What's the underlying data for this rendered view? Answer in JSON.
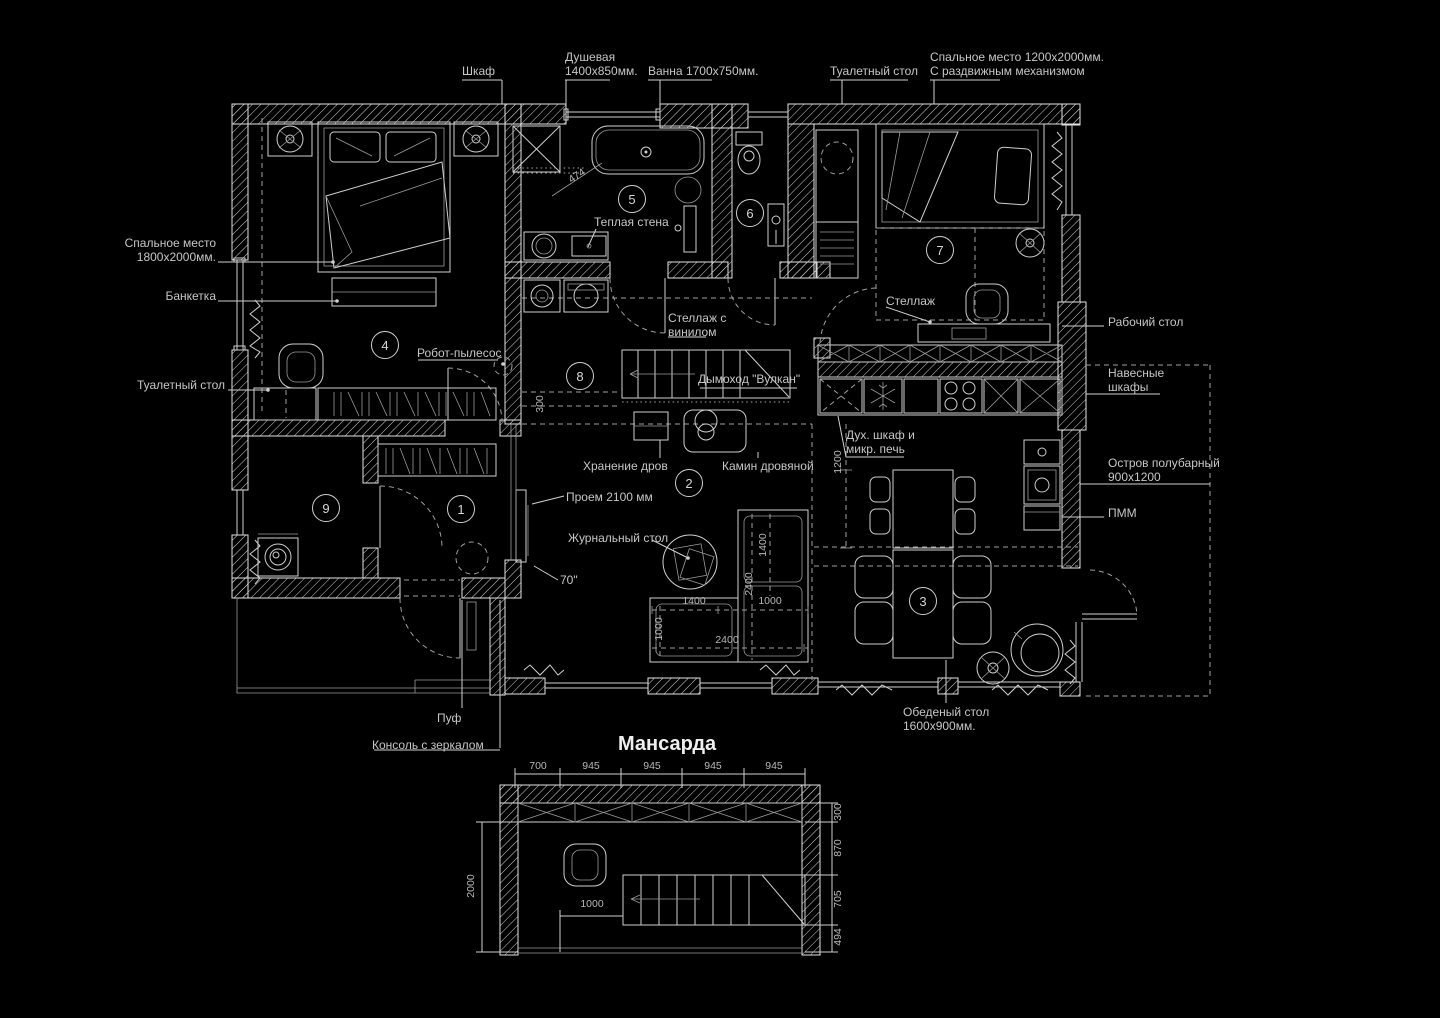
{
  "palette": {
    "background": "#000000",
    "wall_line": "#e4e4e4",
    "furniture_line": "#cfcfcf",
    "dashed_line": "#9f9f9f",
    "leader_line": "#8f8f8f",
    "text": "#c6c6c6",
    "dim_text": "#b8b8b8",
    "title_text": "#efefef"
  },
  "attic": {
    "title": "Мансарда",
    "dims_top": [
      "700",
      "945",
      "945",
      "945",
      "945"
    ],
    "dim_left": "2000",
    "dim_inner": "1000",
    "dims_right": [
      "300",
      "870",
      "705",
      "494"
    ]
  },
  "rooms": [
    {
      "number": "1"
    },
    {
      "number": "2"
    },
    {
      "number": "3"
    },
    {
      "number": "4"
    },
    {
      "number": "5"
    },
    {
      "number": "6"
    },
    {
      "number": "7"
    },
    {
      "number": "8"
    },
    {
      "number": "9"
    }
  ],
  "callouts": {
    "top": {
      "wardrobe": "Шкаф",
      "shower": "Душевая\n1400х850мм.",
      "bath": "Ванна 1700х750мм.",
      "dressing_table": "Туалетный стол",
      "sliding_bed": "Спальное место 1200х2000мм.\nС раздвижным механизмом"
    },
    "left": {
      "main_bed": "Спальное место\n1800х2000мм.",
      "banquette": "Банкетка",
      "dressing_table": "Туалетный стол"
    },
    "right": {
      "work_desk": "Рабочий стол",
      "wall_cabinets": "Навесные\nшкафы",
      "island": "Остров полубарный\n900х1200",
      "dishwasher": "ПММ"
    },
    "bottom": {
      "pouf": "Пуф",
      "mirror_console": "Консоль с зеркалом",
      "dining_table": "Обеденый стол\n1600х900мм."
    },
    "inner": {
      "warm_wall": "Теплая стена",
      "vinyl_shelf": "Стеллаж с\nвинилом",
      "robot_vacuum": "Робот-пылесос",
      "chimney": "Дымоход \"Вулкан\"",
      "shelf": "Стеллаж",
      "oven_microwave": "Дух. шкаф и\nмикр. печь",
      "firewood": "Хранение дров",
      "fireplace": "Камин дровяной",
      "opening": "Проем 2100 мм",
      "coffee_table": "Журнальный стол",
      "tv_size": "70\""
    }
  },
  "dims": {
    "shower_diag": "474",
    "corridor": "300",
    "island_len": "1200",
    "sofa_chaise_len": "1400",
    "sofa_total_v": "2400",
    "sofa_seg1": "1400",
    "sofa_seg2": "1000",
    "sofa_depth": "1000",
    "sofa_total_h": "2400"
  }
}
